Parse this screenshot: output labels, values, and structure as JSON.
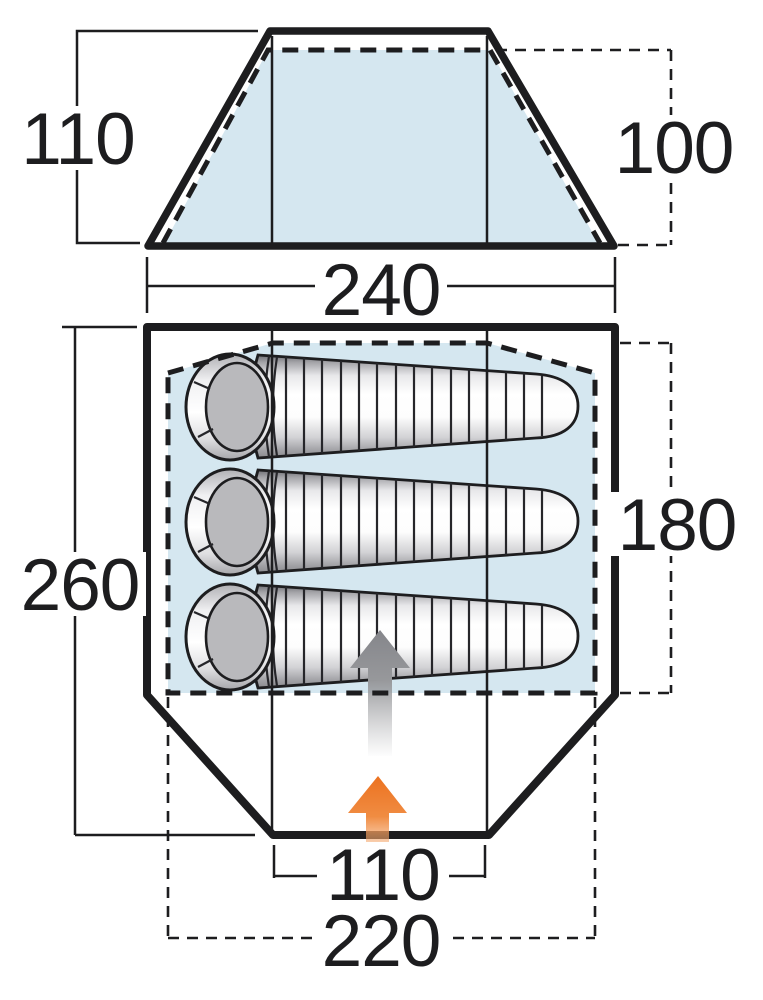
{
  "diagram": {
    "description": "Tent dimension diagram with front elevation and floor plan",
    "front_elevation": {
      "outer_height_label": "110",
      "inner_height_label": "100",
      "base_width_label": "240"
    },
    "floor_plan": {
      "length_label": "260",
      "inner_length_label": "180",
      "door_width_label": "110",
      "inner_width_label": "220",
      "sleeping_bag_count": "3"
    },
    "colors": {
      "line": "#1d1d1f",
      "inner_fill": "#d5e7f0",
      "bag_gray": "#b9b9bc",
      "arrow_gray": "#88898d",
      "arrow_orange": "#ec7220"
    }
  }
}
